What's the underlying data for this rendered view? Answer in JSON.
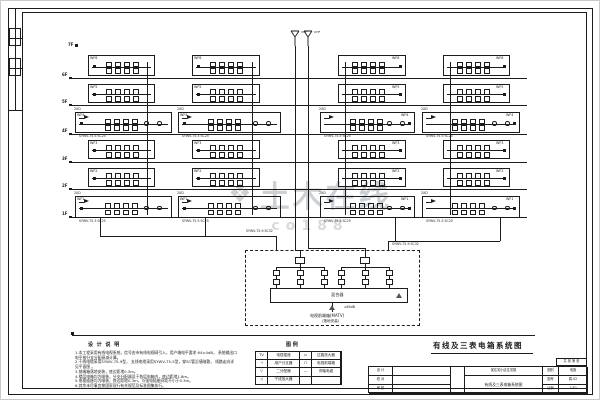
{
  "watermark": {
    "logo": "❖",
    "text": "土木在线",
    "sub": "co188",
    "color": "#ccd1d5"
  },
  "title": {
    "text": "有线及三表电箱系统图"
  },
  "notes": {
    "header": "设 计 说 明",
    "lines": [
      "1.本工程采用有线电视系统，信号由市有线电视网引入，用户端电平要求 64±4dB，  系统输出口电平按分支分配衰减计算。",
      "2.干线电缆采用SYWV-75-9型，  支线电缆采用SYWV-75-5型，穿SC管沿墙暗敷，  线路走向详见平面图 。",
      "3.前端箱落地安装，底边距地0.3m。",
      "4.楼层电箱均为暗装，分支分配器设于各层电箱内，底边距地1.8m。",
      "5.电视插座均为暗装，底边距地0.3m，与强电插座间距不小于0.3m。",
      "6.其余未尽事宜按国家现行有关规范及标准图集执行。"
    ]
  },
  "legend": {
    "header": "图  例",
    "rows": [
      [
        "TV",
        "电视插座",
        "▭",
        "过路放大器"
      ],
      [
        "⊣",
        "用户分支器",
        "⊓",
        "电视前端箱"
      ],
      [
        "▽",
        "二分配器",
        "—",
        "同轴电缆"
      ],
      [
        "◁",
        "干线放大器",
        "",
        ""
      ]
    ]
  },
  "title_block": {
    "left_rows": [
      {
        "label": "设 计",
        "value": ""
      },
      {
        "label": "校 对",
        "value": ""
      },
      {
        "label": "审 核",
        "value": ""
      }
    ],
    "project_label": "工程名称",
    "project": "某住宅小区住宅楼",
    "drawing_label": "图 名",
    "drawing": "有线及三表电箱系统图",
    "right_rows": [
      {
        "label": "图别",
        "value": "电施"
      },
      {
        "label": "图号",
        "value": "弱-02"
      },
      {
        "label": "比例",
        "value": "1:50"
      }
    ],
    "corner": "共 张 第 张"
  },
  "schematic": {
    "antennas": [
      {
        "x": 295,
        "label": "VHF"
      },
      {
        "x": 308,
        "label": "UHF"
      }
    ],
    "top_floor_label": "7F",
    "bus": {
      "x1": 70,
      "x2": 527,
      "lines": [
        {
          "y": 78,
          "label": "6F"
        },
        {
          "y": 105,
          "label": "5F"
        },
        {
          "y": 134,
          "label": "4F"
        },
        {
          "y": 162,
          "label": "3F"
        },
        {
          "y": 189,
          "label": "2F"
        },
        {
          "y": 217,
          "label": "1F"
        }
      ]
    },
    "narrow_rows": [
      {
        "y": 55,
        "h": 21,
        "label": "WF6"
      },
      {
        "y": 84,
        "h": 19,
        "label": "WF5"
      },
      {
        "y": 140,
        "h": 19,
        "label": "WF3"
      },
      {
        "y": 168,
        "h": 19,
        "label": "WF2"
      }
    ],
    "narrow_cols": [
      {
        "x": 88,
        "w": 67,
        "side": "left"
      },
      {
        "x": 192,
        "w": 68,
        "side": "left"
      },
      {
        "x": 338,
        "w": 68,
        "side": "right"
      },
      {
        "x": 443,
        "w": 67,
        "side": "right"
      }
    ],
    "wide_rows": [
      {
        "y": 112,
        "h": 21,
        "label": "WF4"
      },
      {
        "y": 196,
        "h": 22,
        "label": "WF1"
      }
    ],
    "wide_cols": [
      {
        "x": 75,
        "w": 97
      },
      {
        "x": 178,
        "w": 103
      },
      {
        "x": 320,
        "w": 95
      },
      {
        "x": 422,
        "w": 98
      }
    ],
    "amp_label": "2XD",
    "cable_label_small": "SYWV-75-5 SC25",
    "cable_label_main": "SYWV-75-9 SC32",
    "cable_floats": [
      {
        "x": 246,
        "y": 230
      },
      {
        "x": 392,
        "y": 243
      }
    ],
    "segments": [
      [
        147,
        62,
        147,
        215
      ],
      [
        252,
        62,
        252,
        215
      ],
      [
        345,
        62,
        345,
        215
      ],
      [
        450,
        62,
        450,
        215
      ],
      [
        295,
        46,
        295,
        250
      ],
      [
        308,
        46,
        308,
        248
      ],
      [
        295,
        250,
        300,
        250
      ],
      [
        300,
        250,
        300,
        257
      ],
      [
        308,
        248,
        365,
        248
      ],
      [
        365,
        248,
        365,
        257
      ],
      [
        100,
        218,
        100,
        236
      ],
      [
        205,
        218,
        205,
        236
      ],
      [
        100,
        236,
        276,
        236
      ],
      [
        276,
        236,
        276,
        250
      ],
      [
        395,
        218,
        395,
        241
      ],
      [
        500,
        218,
        500,
        241
      ],
      [
        388,
        241,
        500,
        241
      ],
      [
        388,
        241,
        388,
        250
      ],
      [
        72,
        335,
        535,
        335
      ]
    ],
    "headend": {
      "box": {
        "x": 245,
        "y": 250,
        "w": 175,
        "h": 76
      },
      "groups": [
        {
          "cx": 300
        },
        {
          "cx": 365
        }
      ],
      "mixer": {
        "x": 270,
        "y": 288,
        "w": 138,
        "h": 15,
        "label": "混合器"
      },
      "input": {
        "x": 332,
        "label1": "电视前端箱(MATV)",
        "label2": "(落地安装)",
        "side": "≥60dB"
      }
    }
  }
}
